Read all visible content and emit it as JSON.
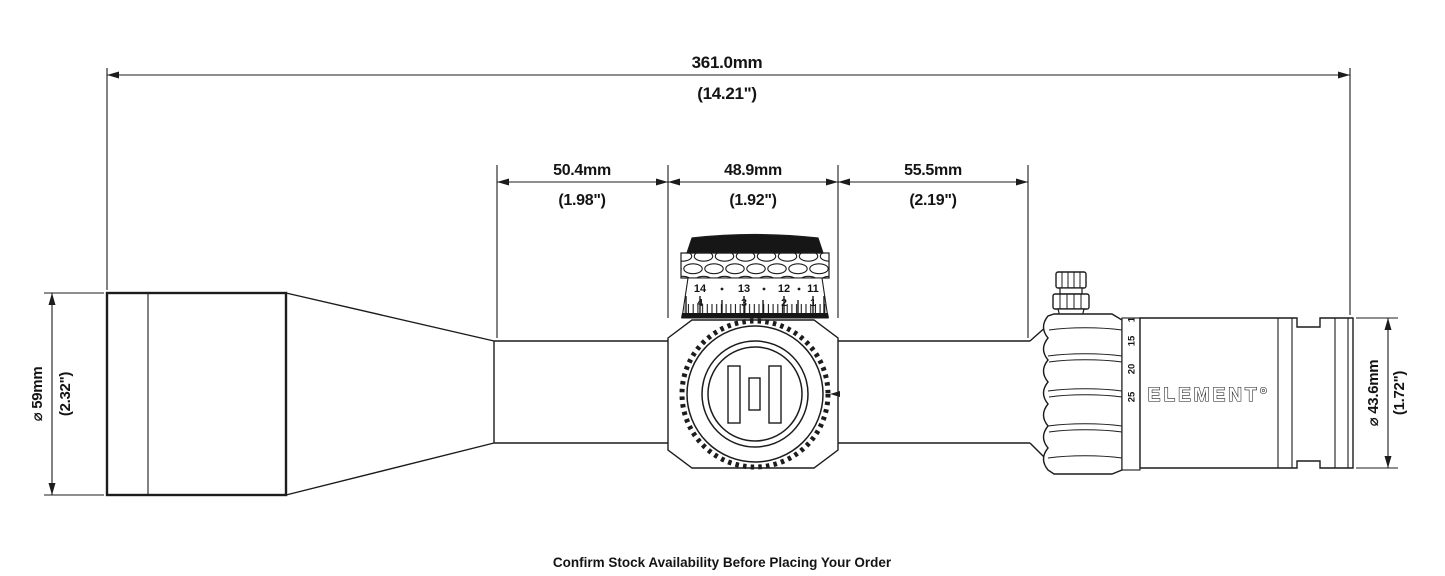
{
  "dimensions": {
    "overall_length": {
      "metric": "361.0mm",
      "imperial": "(14.21\")"
    },
    "front_tube": {
      "metric": "50.4mm",
      "imperial": "(1.98\")"
    },
    "saddle": {
      "metric": "48.9mm",
      "imperial": "(1.92\")"
    },
    "rear_tube": {
      "metric": "55.5mm",
      "imperial": "(2.19\")"
    },
    "objective_diameter": {
      "metric": "⌀ 59mm",
      "imperial": "(2.32\")"
    },
    "eyepiece_diameter": {
      "metric": "⌀ 43.6mm",
      "imperial": "(1.72\")"
    }
  },
  "scope": {
    "brand_logo": "ELEMENT°",
    "elevation_turret": {
      "scale_row_top": [
        "14",
        "13",
        "12",
        "11"
      ],
      "scale_row_bottom": [
        "4",
        "3",
        "2",
        "1"
      ]
    },
    "magnification_ring": {
      "labels": [
        "10",
        "15",
        "20",
        "25"
      ]
    }
  },
  "footer": {
    "note": "Confirm Stock Availability Before Placing Your Order"
  },
  "colors": {
    "line": "#1c1c1c",
    "background": "#ffffff",
    "turret_cap": "#161616"
  }
}
